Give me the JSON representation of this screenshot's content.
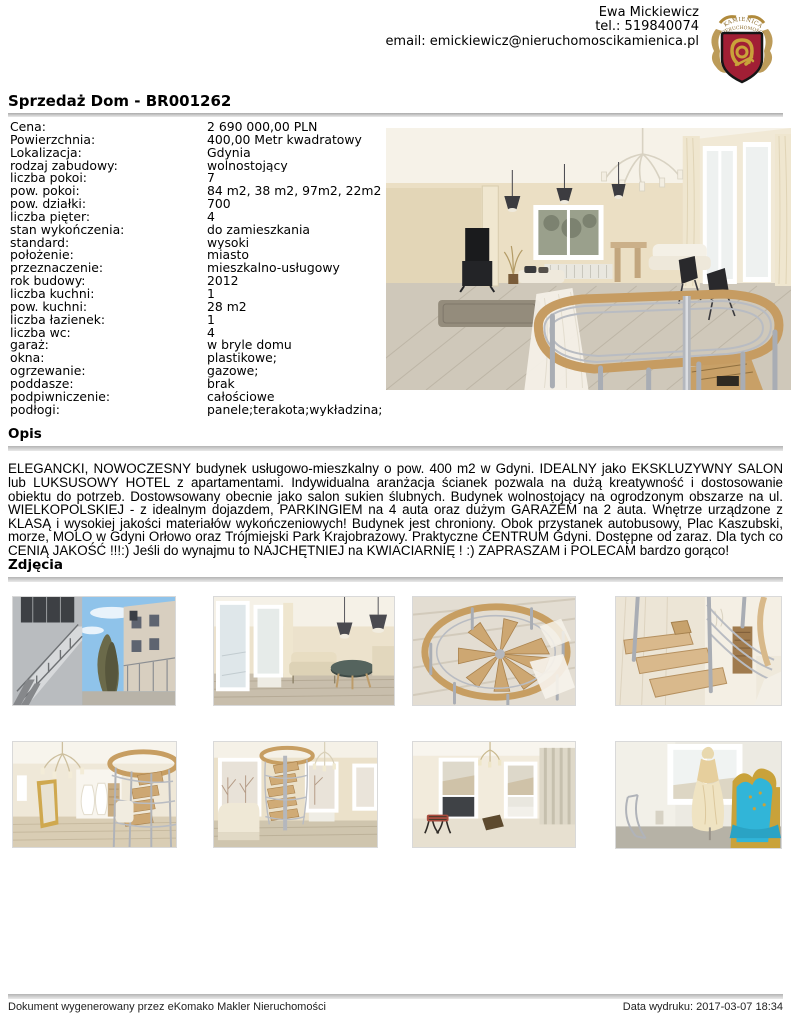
{
  "header": {
    "agent_name": "Ewa Mickiewicz",
    "phone": "tel.: 519840074",
    "email": "email: emickiewicz@nieruchomoscikamienica.pl",
    "logo": {
      "arc_text_top": "KAMIENICA",
      "arc_text_bottom": "NIERUCHOMOŚCI"
    }
  },
  "title": "Sprzedaż Dom - BR001262",
  "details": {
    "rows": [
      {
        "label": "Cena:",
        "value": "2 690 000,00 PLN"
      },
      {
        "label": "Powierzchnia:",
        "value": "400,00 Metr kwadratowy"
      },
      {
        "label": "Lokalizacja:",
        "value": "Gdynia"
      },
      {
        "label": "rodzaj zabudowy:",
        "value": "wolnostojący"
      },
      {
        "label": "liczba pokoi:",
        "value": "7"
      },
      {
        "label": "pow. pokoi:",
        "value": "84 m2, 38 m2, 97m2, 22m2"
      },
      {
        "label": "pow. działki:",
        "value": "700"
      },
      {
        "label": "liczba pięter:",
        "value": "4"
      },
      {
        "label": "stan wykończenia:",
        "value": "do zamieszkania"
      },
      {
        "label": "standard:",
        "value": "wysoki"
      },
      {
        "label": "położenie:",
        "value": "miasto"
      },
      {
        "label": "przeznaczenie:",
        "value": "mieszkalno-usługowy"
      },
      {
        "label": "rok budowy:",
        "value": "2012"
      },
      {
        "label": "liczba kuchni:",
        "value": "1"
      },
      {
        "label": "pow. kuchni:",
        "value": "28 m2"
      },
      {
        "label": "liczba łazienek:",
        "value": "1"
      },
      {
        "label": "liczba wc:",
        "value": "4"
      },
      {
        "label": "garaż:",
        "value": "w bryle domu"
      },
      {
        "label": "okna:",
        "value": "plastikowe;"
      },
      {
        "label": "ogrzewanie:",
        "value": "gazowe;"
      },
      {
        "label": "poddasze:",
        "value": "brak"
      },
      {
        "label": "podpiwniczenie:",
        "value": "całościowe"
      },
      {
        "label": "podłogi:",
        "value": "panele;terakota;wykładzina;"
      }
    ]
  },
  "sections": {
    "opis": "Opis",
    "zdjecia": "Zdjęcia"
  },
  "description": "ELEGANCKI, NOWOCZESNY budynek usługowo-mieszkalny o pow. 400 m2 w Gdyni. IDEALNY jako EKSKLUZYWNY SALON lub LUKSUSOWY HOTEL z apartamentami. Indywidualna aranżacja ścianek pozwala na dużą kreatywność i dostosowanie obiektu do potrzeb. Dostowsowany obecnie jako salon sukien ślubnych. Budynek wolnostojący na ogrodzonym obszarze na ul. WIELKOPOLSKIEJ - z idealnym dojazdem, PARKINGIEM na 4 auta oraz dużym GARAŻEM na 2 auta. Wnętrze urządzone z KLASĄ i wysokiej jakości materiałów wykończeniowych! Budynek jest chroniony. Obok przystanek autobusowy, Plac Kaszubski, morze, MOLO w Gdyni Orłowo oraz Trójmiejski Park Krajobrazowy. Praktyczne CENTRUM Gdyni. Dostępne od zaraz. Dla tych co CENIĄ JAKOŚĆ !!!:) Jeśli do wynajmu to NAJCHĘTNIEJ na KWIACIARNIĘ ! :) ZAPRASZAM i POLECAM bardzo gorąco!",
  "photos": {
    "main": {
      "name": "living room with spiral staircase, chandelier and window"
    },
    "items": [
      {
        "name": "exterior outdoor staircase and buildings"
      },
      {
        "name": "living room with large windows and sofa"
      },
      {
        "name": "spiral staircase seen from above"
      },
      {
        "name": "landing with wooden steps and metal railing"
      },
      {
        "name": "hall with chandelier, gold mirror and wedding dresses"
      },
      {
        "name": "room with spiral staircase between windows"
      },
      {
        "name": "bright room with two windows and stool"
      },
      {
        "name": "wedding dress by window and turquoise baroque chair"
      }
    ]
  },
  "footer": {
    "left": "Dokument wygenerowany przez eKomako Makler Nieruchomości",
    "right": "Data wydruku: 2017-03-07 18:34"
  },
  "colors": {
    "heading_bar_top": "#ababab",
    "heading_bar_bottom": "#e9e9e9",
    "logo_red": "#a11f35",
    "logo_gold": "#c09a42"
  }
}
